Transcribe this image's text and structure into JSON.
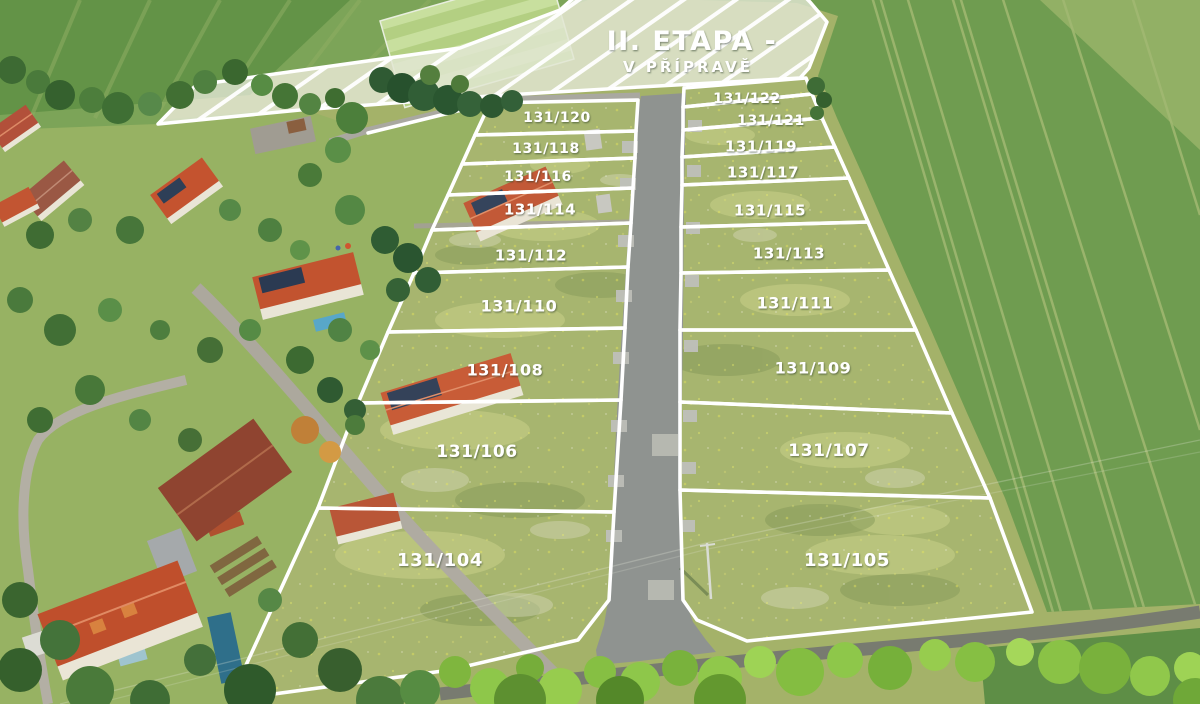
{
  "banner": {
    "title": "II. ETAPA -",
    "subtitle": "V PŘÍPRAVĚ"
  },
  "site": {
    "name": "residential-plot-development",
    "plots": [
      {
        "label": "131/120",
        "points": "490,103 638,100 636,131 475,135",
        "lx": 557,
        "ly": 118,
        "fs": 14
      },
      {
        "label": "131/118",
        "points": "475,135 636,131 635,158 462,164",
        "lx": 546,
        "ly": 149,
        "fs": 14
      },
      {
        "label": "131/116",
        "points": "462,164 635,158 633,188 448,195",
        "lx": 538,
        "ly": 177,
        "fs": 14
      },
      {
        "label": "131/114",
        "points": "448,195 633,188 631,223 432,230",
        "lx": 540,
        "ly": 210,
        "fs": 15
      },
      {
        "label": "131/112",
        "points": "432,230 631,223 628,267 414,273",
        "lx": 531,
        "ly": 256,
        "fs": 15
      },
      {
        "label": "131/110",
        "points": "414,273 628,267 625,328 388,332",
        "lx": 519,
        "ly": 307,
        "fs": 16
      },
      {
        "label": "131/108",
        "points": "388,332 625,328 621,400 358,403",
        "lx": 505,
        "ly": 371,
        "fs": 16
      },
      {
        "label": "131/106",
        "points": "358,403 621,400 614,512 318,508",
        "lx": 477,
        "ly": 452,
        "fs": 17
      },
      {
        "label": "131/104",
        "points": "318,508 614,512 609,600 578,640 450,670 230,700",
        "lx": 440,
        "ly": 561,
        "fs": 18
      },
      {
        "label": "131/122",
        "points": "684,88 806,78 812,94 683,107",
        "lx": 747,
        "ly": 99,
        "fs": 14
      },
      {
        "label": "131/121",
        "points": "683,107 812,94 822,118 683,130",
        "lx": 771,
        "ly": 121,
        "fs": 14
      },
      {
        "label": "131/119",
        "points": "683,130 822,118 835,147 682,157",
        "lx": 761,
        "ly": 147,
        "fs": 15
      },
      {
        "label": "131/117",
        "points": "682,157 835,147 849,178 682,185",
        "lx": 763,
        "ly": 173,
        "fs": 15
      },
      {
        "label": "131/115",
        "points": "682,185 849,178 868,222 681,227",
        "lx": 770,
        "ly": 211,
        "fs": 15
      },
      {
        "label": "131/113",
        "points": "681,227 868,222 889,270 681,273",
        "lx": 789,
        "ly": 254,
        "fs": 15
      },
      {
        "label": "131/111",
        "points": "681,273 889,270 916,330 680,330",
        "lx": 795,
        "ly": 304,
        "fs": 16
      },
      {
        "label": "131/109",
        "points": "680,330 916,330 952,413 680,402",
        "lx": 813,
        "ly": 369,
        "fs": 16
      },
      {
        "label": "131/107",
        "points": "680,402 952,413 990,498 680,490",
        "lx": 829,
        "ly": 451,
        "fs": 17
      },
      {
        "label": "131/105",
        "points": "680,490 990,498 1032,612 747,641 697,620 683,600",
        "lx": 847,
        "ly": 561,
        "fs": 18
      }
    ]
  },
  "colors": {
    "plot_outline": "#ffffff",
    "label_text": "#ffffff",
    "new_road": "#8f9390",
    "existing_road": "#787b70",
    "banner_fill": "#e2e6d3",
    "meadow": "#a4b269",
    "crop_field": "#6f9c50",
    "village_lawn": "#97b263",
    "roof_red": "#c2532f"
  }
}
